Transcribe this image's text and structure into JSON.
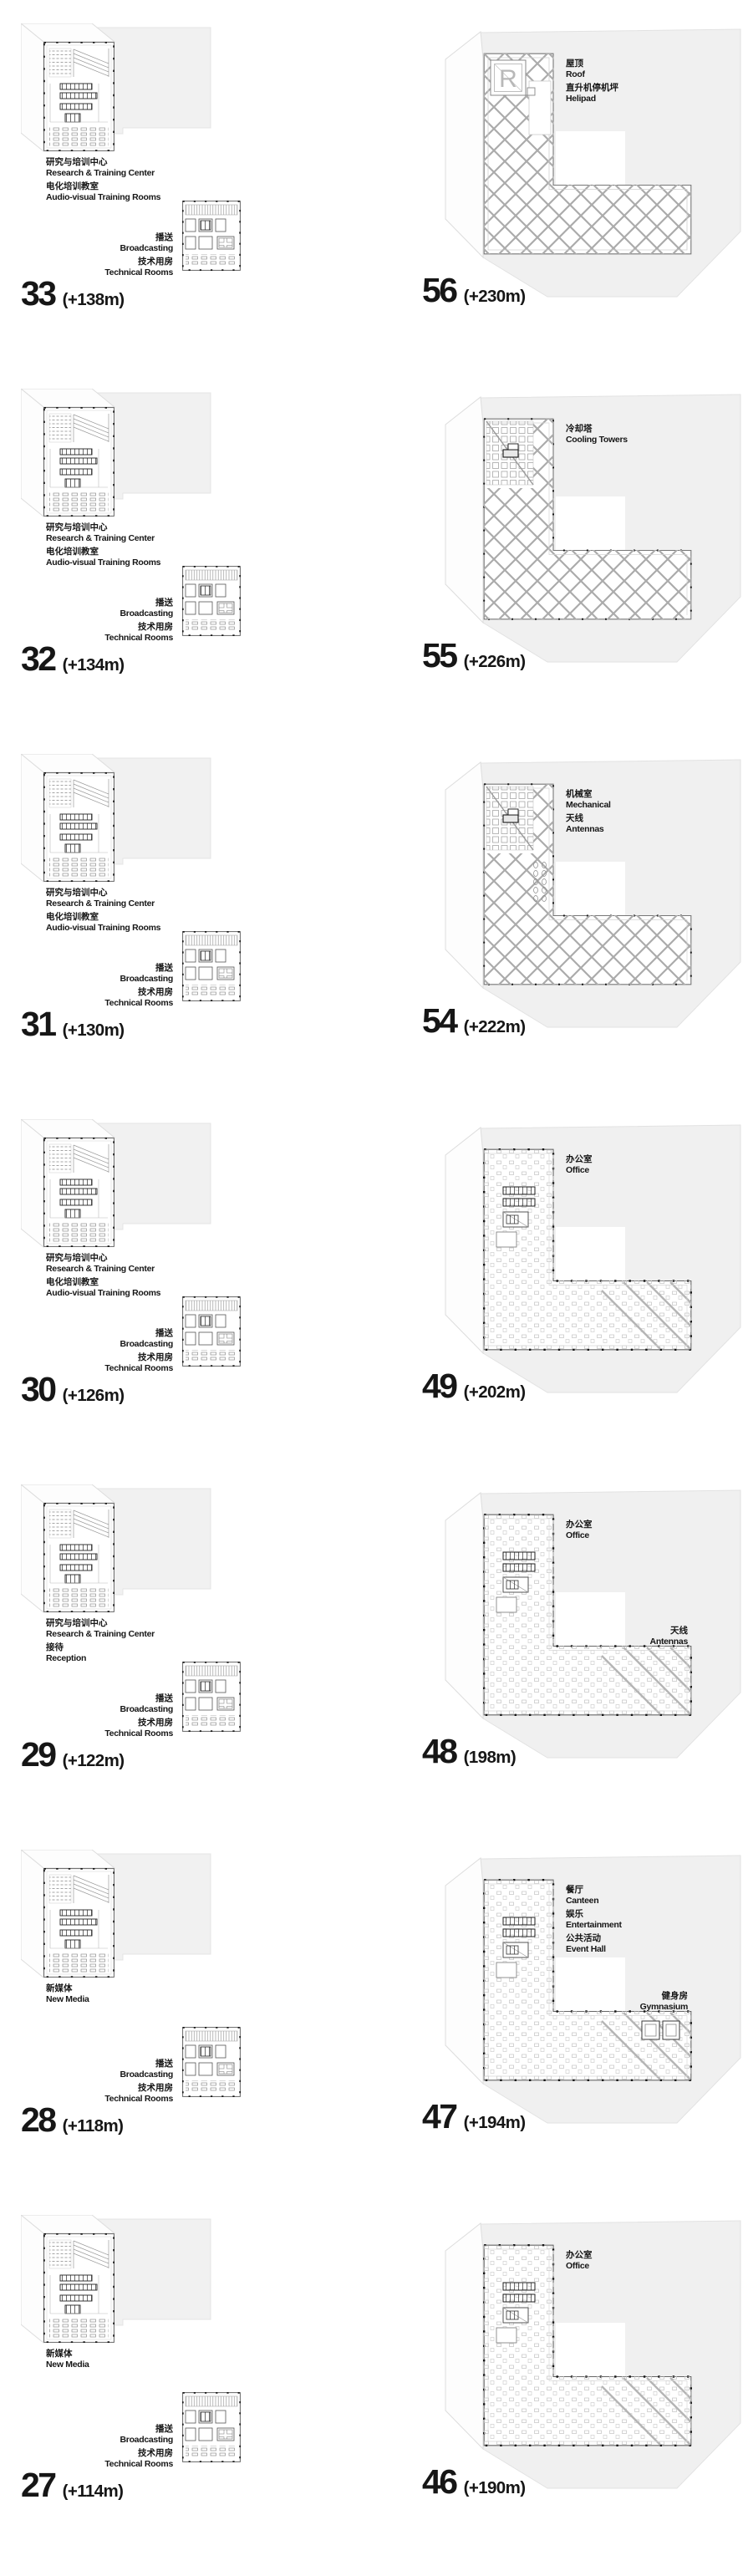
{
  "colors": {
    "text": "#161616",
    "slab_gray": "#f0f0f0",
    "plan_line": "#666666",
    "diagrid_line": "#ababab"
  },
  "floors": {
    "left": [
      {
        "number": "33",
        "height": "(+138m)",
        "main": [
          {
            "zh": "研究与培训中心",
            "en": "Research & Training Center"
          },
          {
            "zh": "电化培训教室",
            "en": "Audio-visual Training Rooms"
          }
        ],
        "side": [
          {
            "zh": "播送",
            "en": "Broadcasting"
          },
          {
            "zh": "技术用房",
            "en": "Technical Rooms"
          }
        ]
      },
      {
        "number": "32",
        "height": "(+134m)",
        "main": [
          {
            "zh": "研究与培训中心",
            "en": "Research & Training Center"
          },
          {
            "zh": "电化培训教室",
            "en": "Audio-visual Training Rooms"
          }
        ],
        "side": [
          {
            "zh": "播送",
            "en": "Broadcasting"
          },
          {
            "zh": "技术用房",
            "en": "Technical Rooms"
          }
        ]
      },
      {
        "number": "31",
        "height": "(+130m)",
        "main": [
          {
            "zh": "研究与培训中心",
            "en": "Research & Training Center"
          },
          {
            "zh": "电化培训教室",
            "en": "Audio-visual Training Rooms"
          }
        ],
        "side": [
          {
            "zh": "播送",
            "en": "Broadcasting"
          },
          {
            "zh": "技术用房",
            "en": "Technical Rooms"
          }
        ]
      },
      {
        "number": "30",
        "height": "(+126m)",
        "main": [
          {
            "zh": "研究与培训中心",
            "en": "Research & Training Center"
          },
          {
            "zh": "电化培训教室",
            "en": "Audio-visual Training Rooms"
          }
        ],
        "side": [
          {
            "zh": "播送",
            "en": "Broadcasting"
          },
          {
            "zh": "技术用房",
            "en": "Technical Rooms"
          }
        ]
      },
      {
        "number": "29",
        "height": "(+122m)",
        "main": [
          {
            "zh": "研究与培训中心",
            "en": "Research & Training Center"
          },
          {
            "zh": "接待",
            "en": "Reception"
          }
        ],
        "side": [
          {
            "zh": "播送",
            "en": "Broadcasting"
          },
          {
            "zh": "技术用房",
            "en": "Technical Rooms"
          }
        ]
      },
      {
        "number": "28",
        "height": "(+118m)",
        "main": [
          {
            "zh": "新媒体",
            "en": "New Media"
          }
        ],
        "side": [
          {
            "zh": "播送",
            "en": "Broadcasting"
          },
          {
            "zh": "技术用房",
            "en": "Technical Rooms"
          }
        ]
      },
      {
        "number": "27",
        "height": "(+114m)",
        "main": [
          {
            "zh": "新媒体",
            "en": "New Media"
          }
        ],
        "side": [
          {
            "zh": "播送",
            "en": "Broadcasting"
          },
          {
            "zh": "技术用房",
            "en": "Technical Rooms"
          }
        ]
      }
    ],
    "right": [
      {
        "number": "56",
        "height": "(+230m)",
        "top": [
          {
            "zh": "屋顶",
            "en": "Roof"
          },
          {
            "zh": "直升机停机坪",
            "en": "Helipad"
          }
        ]
      },
      {
        "number": "55",
        "height": "(+226m)",
        "top": [
          {
            "zh": "冷却塔",
            "en": "Cooling Towers"
          }
        ]
      },
      {
        "number": "54",
        "height": "(+222m)",
        "top": [
          {
            "zh": "机械室",
            "en": "Mechanical"
          },
          {
            "zh": "天线",
            "en": "Antennas"
          }
        ]
      },
      {
        "number": "49",
        "height": "(+202m)",
        "top": [
          {
            "zh": "办公室",
            "en": "Office"
          }
        ]
      },
      {
        "number": "48",
        "height": "(198m)",
        "top": [
          {
            "zh": "办公室",
            "en": "Office"
          }
        ],
        "right_note": [
          {
            "zh": "天线",
            "en": "Antennas"
          }
        ]
      },
      {
        "number": "47",
        "height": "(+194m)",
        "top": [
          {
            "zh": "餐厅",
            "en": "Canteen"
          },
          {
            "zh": "娱乐",
            "en": "Entertainment"
          },
          {
            "zh": "公共活动",
            "en": "Event Hall"
          }
        ],
        "right_note": [
          {
            "zh": "健身房",
            "en": "Gymnasium"
          }
        ]
      },
      {
        "number": "46",
        "height": "(+190m)",
        "top": [
          {
            "zh": "办公室",
            "en": "Office"
          }
        ]
      }
    ]
  }
}
